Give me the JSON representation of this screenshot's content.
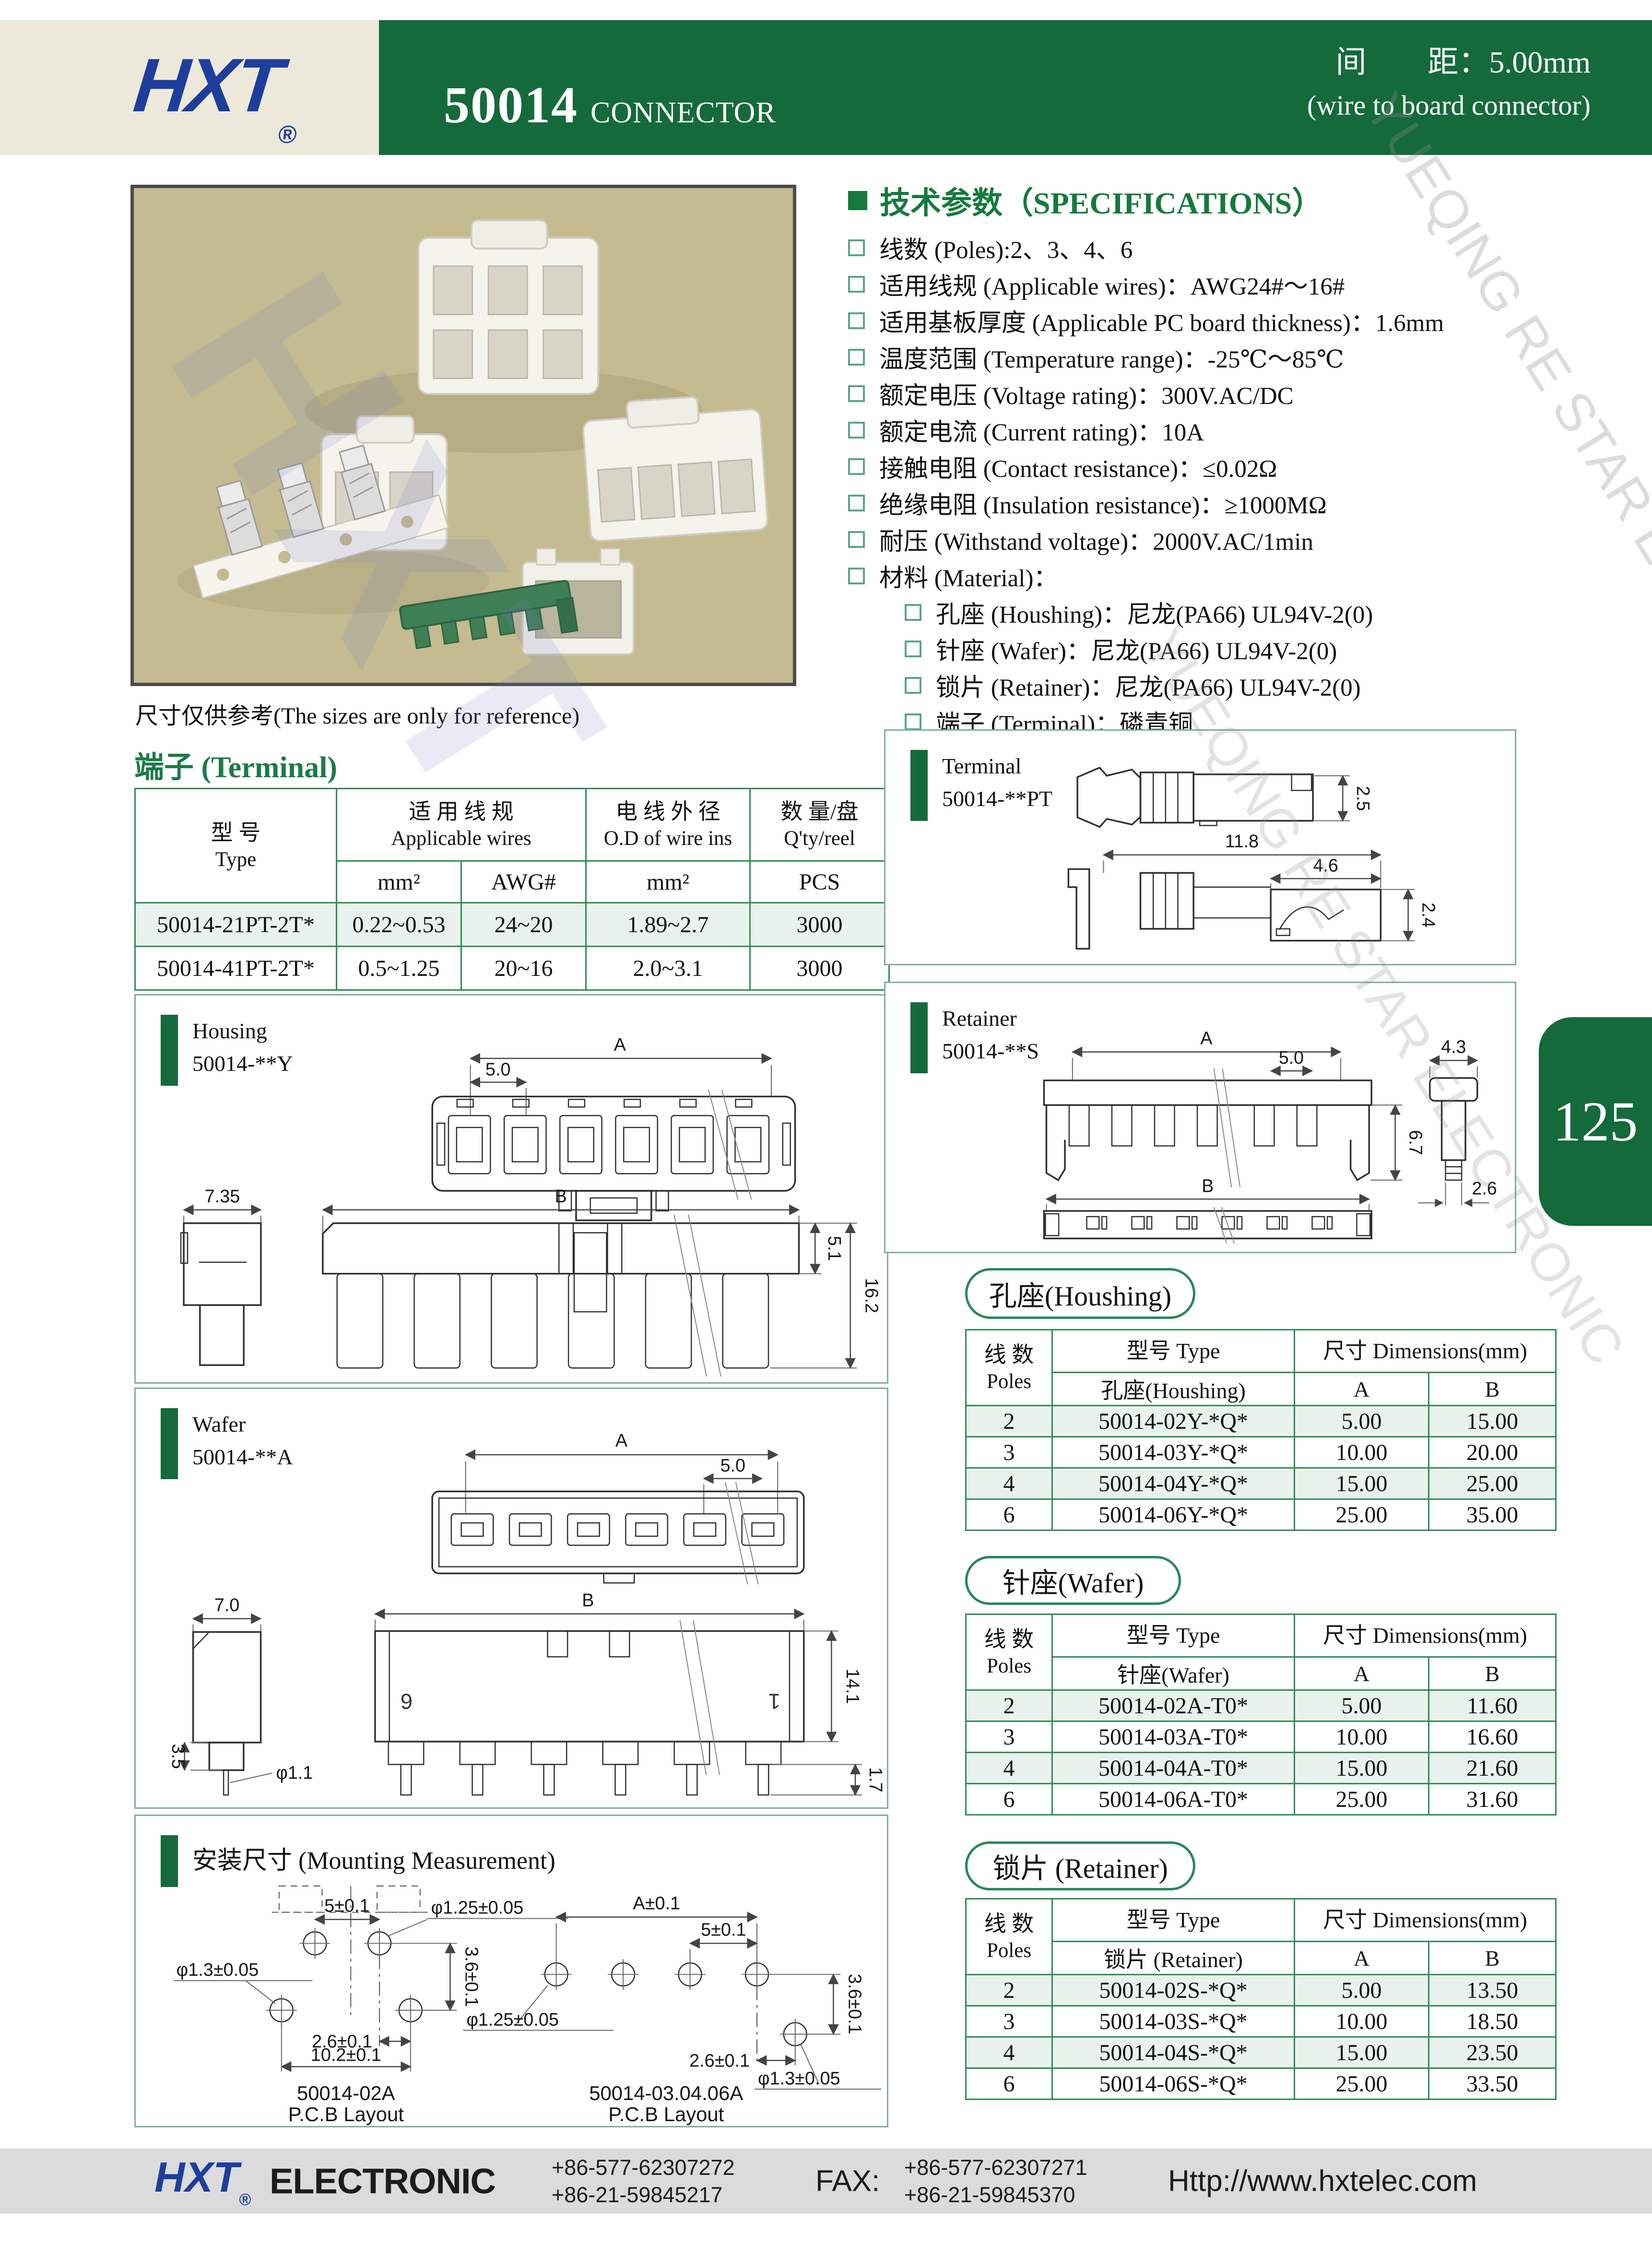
{
  "header": {
    "logo": "HXT",
    "logo_reg": "®",
    "part_number": "50014",
    "part_suffix": "CONNECTOR",
    "pitch_line": "间　　距：5.00mm",
    "subtitle": "(wire to board connector)"
  },
  "photo": {
    "caption": "尺寸仅供参考(The sizes are only for reference)"
  },
  "specs": {
    "title": "技术参数（SPECIFICATIONS）",
    "items": [
      {
        "text": "线数 (Poles):2、3、4、6"
      },
      {
        "text": "适用线规 (Applicable wires)：AWG24#～16#"
      },
      {
        "text": "适用基板厚度 (Applicable PC board thickness)：1.6mm"
      },
      {
        "text": "温度范围 (Temperature range)：-25℃～85℃"
      },
      {
        "text": "额定电压 (Voltage rating)：300V.AC/DC"
      },
      {
        "text": "额定电流 (Current rating)：10A"
      },
      {
        "text": "接触电阻 (Contact resistance)：≤0.02Ω"
      },
      {
        "text": "绝缘电阻 (Insulation resistance)：≥1000MΩ"
      },
      {
        "text": "耐压 (Withstand voltage)：2000V.AC/1min"
      },
      {
        "text": "材料 (Material)："
      },
      {
        "text": "孔座 (Houshing)：尼龙(PA66) UL94V-2(0)"
      },
      {
        "text": "针座 (Wafer)：尼龙(PA66) UL94V-2(0)"
      },
      {
        "text": "锁片 (Retainer)：尼龙(PA66) UL94V-2(0)"
      },
      {
        "text": "端子 (Terminal)：磷青铜"
      }
    ]
  },
  "terminal_section": {
    "title": "端子 (Terminal)",
    "table": {
      "h_type": "型 号",
      "h_type_en": "Type",
      "h_wires": "适 用 线 规",
      "h_wires_en": "Applicable wires",
      "h_od": "电 线 外 径",
      "h_od_en": "O.D of wire ins",
      "h_qty": "数 量/盘",
      "h_qty_en": "Q'ty/reel",
      "sub_mm": "mm²",
      "sub_awg": "AWG#",
      "sub_mm2": "mm²",
      "sub_pcs": "PCS",
      "rows": [
        [
          "50014-21PT-2T*",
          "0.22~0.53",
          "24~20",
          "1.89~2.7",
          "3000"
        ],
        [
          "50014-41PT-2T*",
          "0.5~1.25",
          "20~16",
          "2.0~3.1",
          "3000"
        ]
      ]
    }
  },
  "drawings": {
    "housing": {
      "name": "Housing",
      "code": "50014-**Y",
      "dim_a": "A",
      "dim_pitch": "5.0",
      "dim_w": "7.35",
      "dim_b": "B",
      "dim_h1": "5.1",
      "dim_h2": "16.2"
    },
    "wafer": {
      "name": "Wafer",
      "code": "50014-**A",
      "dim_a": "A",
      "dim_pitch": "5.0",
      "dim_w": "7.0",
      "dim_b": "B",
      "dim_h": "14.1",
      "dim_l1": "3.5",
      "dim_pin": "φ1.1",
      "dim_l2": "1.7",
      "pin6": "6",
      "pin1": "1"
    },
    "terminal": {
      "name": "Terminal",
      "code": "50014-**PT",
      "dim_h": "2.5",
      "dim_len": "11.8",
      "dim_l2": "4.6",
      "dim_h2": "2.4"
    },
    "retainer": {
      "name": "Retainer",
      "code": "50014-**S",
      "dim_a": "A",
      "dim_pitch": "5.0",
      "dim_w": "4.3",
      "dim_h": "6.7",
      "dim_t": "2.6",
      "dim_b": "B"
    },
    "mounting": {
      "title": "安装尺寸 (Mounting Measurement)",
      "left": {
        "d_pitch": "5±0.1",
        "d_hole1": "φ1.25±0.05",
        "d_hole2": "φ1.3±0.05",
        "d_v": "3.6±0.1",
        "d_off": "2.6±0.1",
        "d_span": "10.2±0.1",
        "caption": "50014-02A",
        "caption2": "P.C.B Layout"
      },
      "right": {
        "d_a": "A±0.1",
        "d_pitch": "5±0.1",
        "d_hole1": "φ1.25±0.05",
        "d_v": "3.6±0.1",
        "d_off": "2.6±0.1",
        "d_hole2": "φ1.3±0.05",
        "caption": "50014-03.04.06A",
        "caption2": "P.C.B Layout"
      }
    }
  },
  "part_tables": {
    "housing": {
      "title": "孔座(Houshing)",
      "h_poles": "线 数",
      "h_poles_en": "Poles",
      "h_type": "型号 Type",
      "h_dims": "尺寸 Dimensions(mm)",
      "h_sub": "孔座(Houshing)",
      "h_a": "A",
      "h_b": "B",
      "rows": [
        [
          "2",
          "50014-02Y-*Q*",
          "5.00",
          "15.00"
        ],
        [
          "3",
          "50014-03Y-*Q*",
          "10.00",
          "20.00"
        ],
        [
          "4",
          "50014-04Y-*Q*",
          "15.00",
          "25.00"
        ],
        [
          "6",
          "50014-06Y-*Q*",
          "25.00",
          "35.00"
        ]
      ]
    },
    "wafer": {
      "title": "针座(Wafer)",
      "h_poles": "线 数",
      "h_poles_en": "Poles",
      "h_type": "型号 Type",
      "h_dims": "尺寸 Dimensions(mm)",
      "h_sub": "针座(Wafer)",
      "h_a": "A",
      "h_b": "B",
      "rows": [
        [
          "2",
          "50014-02A-T0*",
          "5.00",
          "11.60"
        ],
        [
          "3",
          "50014-03A-T0*",
          "10.00",
          "16.60"
        ],
        [
          "4",
          "50014-04A-T0*",
          "15.00",
          "21.60"
        ],
        [
          "6",
          "50014-06A-T0*",
          "25.00",
          "31.60"
        ]
      ]
    },
    "retainer": {
      "title": "锁片 (Retainer)",
      "h_poles": "线 数",
      "h_poles_en": "Poles",
      "h_type": "型号 Type",
      "h_dims": "尺寸 Dimensions(mm)",
      "h_sub": "锁片 (Retainer)",
      "h_a": "A",
      "h_b": "B",
      "rows": [
        [
          "2",
          "50014-02S-*Q*",
          "5.00",
          "13.50"
        ],
        [
          "3",
          "50014-03S-*Q*",
          "10.00",
          "18.50"
        ],
        [
          "4",
          "50014-04S-*Q*",
          "15.00",
          "23.50"
        ],
        [
          "6",
          "50014-06S-*Q*",
          "25.00",
          "33.50"
        ]
      ]
    }
  },
  "page_tab": {
    "number": "125"
  },
  "footer": {
    "logo": "HXT",
    "reg": "®",
    "company": "ELECTRONIC",
    "tel1": "+86-577-62307272",
    "tel2": "+86-21-59845217",
    "fax_label": "FAX:",
    "fax1": "+86-577-62307271",
    "fax2": "+86-21-59845370",
    "website": "Http://www.hxtelec.com"
  },
  "watermark": {
    "brand": "HXT",
    "line": "YUEQING RE STAR ELECTRONIC"
  },
  "colors": {
    "brand_green": "#156A3C",
    "accent_green": "#1B7B47",
    "table_border": "#2E8B57",
    "logo_blue": "#1D3E9B",
    "photo_bg": "#C4BB90"
  }
}
